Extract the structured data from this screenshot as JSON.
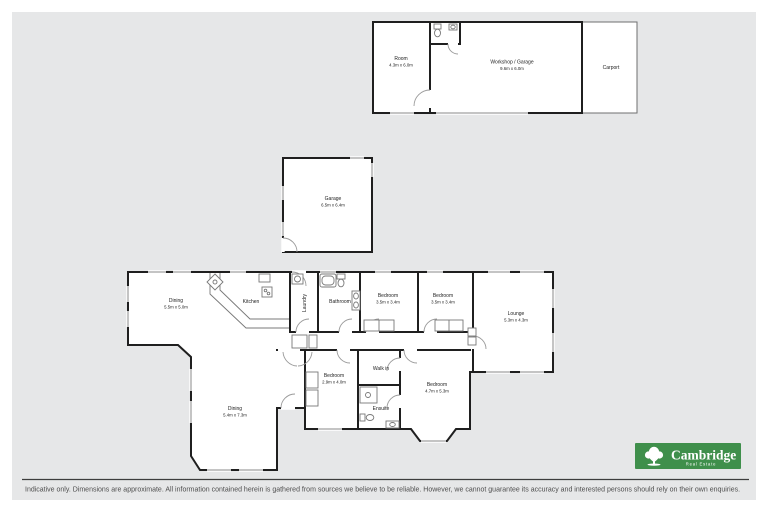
{
  "colors": {
    "panel_background": "#e6e7e8",
    "wall": "#1f1f1f",
    "logo_green": "#3f8f4b"
  },
  "rooms": {
    "room": {
      "name": "Room",
      "dims": "4.3m x 6.0m"
    },
    "workshop": {
      "name": "Workshop / Garage",
      "dims": "9.6m x 6.0m"
    },
    "carport": {
      "name": "Carport"
    },
    "garage": {
      "name": "Garage",
      "dims": "6.5m x 6.4m"
    },
    "dining1": {
      "name": "Dining",
      "dims": "5.5m x 5.0m"
    },
    "kitchen": {
      "name": "Kitchen"
    },
    "laundry": {
      "name": "Laundry"
    },
    "bathroom": {
      "name": "Bathroom"
    },
    "bedroom1": {
      "name": "Bedroom",
      "dims": "3.5m x 3.4m"
    },
    "bedroom2": {
      "name": "Bedroom",
      "dims": "3.5m x 3.4m"
    },
    "lounge": {
      "name": "Lounge",
      "dims": "5.3m x 4.3m"
    },
    "bedroom3": {
      "name": "Bedroom",
      "dims": "2.9m x 4.0m"
    },
    "walkin": {
      "name": "Walk in"
    },
    "ensuite": {
      "name": "Ensuite"
    },
    "bedroom4": {
      "name": "Bedroom",
      "dims": "4.7m x 5.3m"
    },
    "dining2": {
      "name": "Dining",
      "dims": "5.4m x 7.3m"
    }
  },
  "footer": {
    "disclaimer": "Indicative only. Dimensions are approximate. All information contained herein is gathered from sources we believe to be reliable. However, we cannot guarantee its accuracy and interested persons should rely on their own enquiries."
  },
  "brand": {
    "name": "Cambridge",
    "tagline": "Real Estate",
    "color": "#3f8f4b"
  }
}
